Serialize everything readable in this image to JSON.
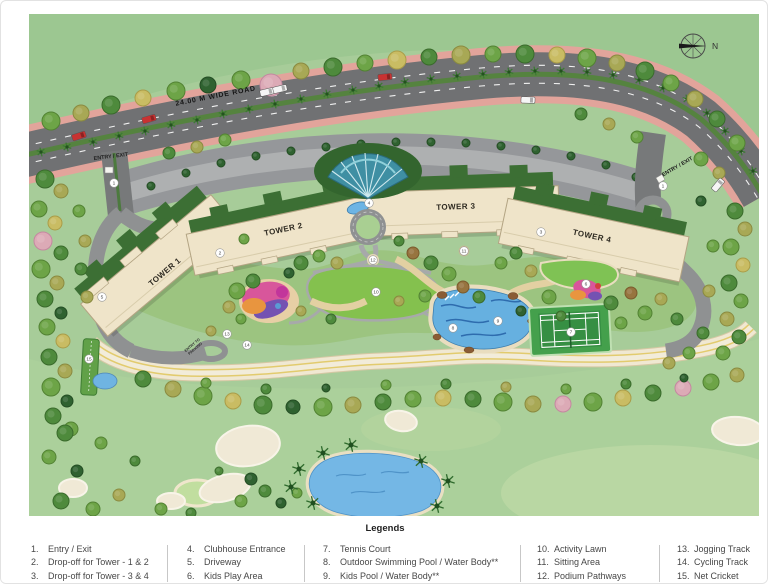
{
  "plan": {
    "road_label": "24.00 M WIDE ROAD",
    "entry_exit_left": "ENTRY / EXIT",
    "entry_exit_right": "ENTRY / EXIT",
    "entry_to_parking_line1": "ENTRY TO",
    "entry_to_parking_line2": "PARKING",
    "compass_north": "N",
    "towers": [
      {
        "label": "TOWER 1"
      },
      {
        "label": "TOWER 2"
      },
      {
        "label": "TOWER 3"
      },
      {
        "label": "TOWER 4"
      }
    ],
    "markers": [
      {
        "n": "1",
        "x": 113,
        "y": 182
      },
      {
        "n": "1",
        "x": 662,
        "y": 185
      },
      {
        "n": "2",
        "x": 219,
        "y": 252
      },
      {
        "n": "3",
        "x": 540,
        "y": 231
      },
      {
        "n": "4",
        "x": 368,
        "y": 202
      },
      {
        "n": "5",
        "x": 101,
        "y": 296
      },
      {
        "n": "6",
        "x": 585,
        "y": 283
      },
      {
        "n": "7",
        "x": 570,
        "y": 331
      },
      {
        "n": "8",
        "x": 452,
        "y": 327
      },
      {
        "n": "9",
        "x": 497,
        "y": 320
      },
      {
        "n": "10",
        "x": 375,
        "y": 291
      },
      {
        "n": "11",
        "x": 463,
        "y": 250
      },
      {
        "n": "12",
        "x": 372,
        "y": 259
      },
      {
        "n": "13",
        "x": 226,
        "y": 333
      },
      {
        "n": "14",
        "x": 246,
        "y": 344
      },
      {
        "n": "15",
        "x": 88,
        "y": 358
      }
    ],
    "colors": {
      "road": "#707173",
      "sidewalk": "#e2a49b",
      "lawn": "#a7cc99",
      "water": "#66b0e0",
      "tower": "#efe4c9",
      "roof": "#3c6f34",
      "activity_lawn": "#84c14e"
    }
  },
  "legend": {
    "title": "Legends",
    "columns": [
      {
        "items": [
          {
            "num": "1.",
            "label": "Entry / Exit"
          },
          {
            "num": "2.",
            "label": "Drop-off for Tower - 1 & 2"
          },
          {
            "num": "3.",
            "label": "Drop-off for Tower - 3 & 4"
          }
        ]
      },
      {
        "items": [
          {
            "num": "4.",
            "label": "Clubhouse Entrance"
          },
          {
            "num": "5.",
            "label": "Driveway"
          },
          {
            "num": "6.",
            "label": "Kids Play Area"
          }
        ]
      },
      {
        "items": [
          {
            "num": "7.",
            "label": "Tennis Court"
          },
          {
            "num": "8.",
            "label": "Outdoor Swimming Pool / Water Body**"
          },
          {
            "num": "9.",
            "label": "Kids Pool / Water Body**"
          }
        ]
      },
      {
        "items": [
          {
            "num": "10.",
            "label": "Activity Lawn"
          },
          {
            "num": "11.",
            "label": "Sitting Area"
          },
          {
            "num": "12.",
            "label": "Podium Pathways"
          }
        ]
      },
      {
        "items": [
          {
            "num": "13.",
            "label": "Jogging Track"
          },
          {
            "num": "14.",
            "label": "Cycling Track"
          },
          {
            "num": "15.",
            "label": "Net Cricket"
          }
        ]
      }
    ]
  }
}
